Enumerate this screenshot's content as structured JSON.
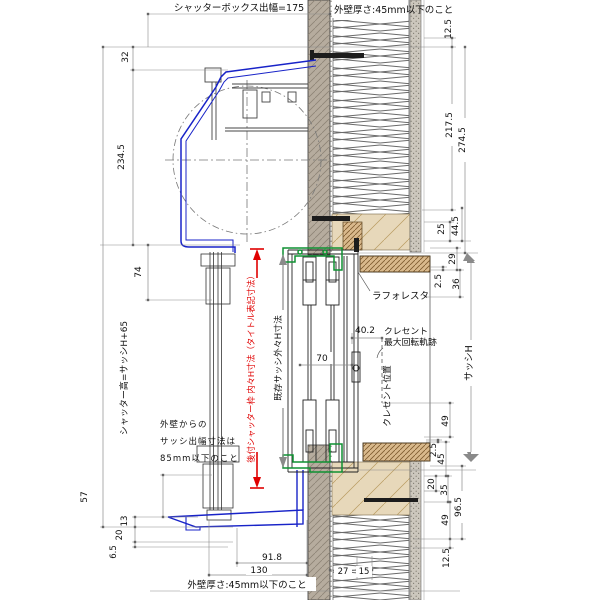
{
  "notes": {
    "shutter_box_depth": "シャッターボックス出幅=175",
    "wall_thickness_top": "外壁厚さ:45mm以下のこと",
    "wall_thickness_bottom": "外壁厚さ:45mm以下のこと",
    "offset_note_1": "外壁からの",
    "offset_note_2": "サッシ出幅寸法は",
    "offset_note_3": "85mm以下のこと"
  },
  "labels": {
    "shutter_height": "シャッター高=サッシH+65",
    "retrofit_frame_dim": "後付シャッター枠 内々H寸法（タイトル表記寸法）",
    "existing_sash_dim": "既存サッシ外々H寸法",
    "sash_h": "サッシH",
    "laforesta": "ラフォレスタ",
    "crescent_1": "クレセント",
    "crescent_2": "最大回転軌跡",
    "crescent_position": "クレセント位置"
  },
  "dims": {
    "left": [
      "32",
      "234.5",
      "74",
      "57",
      "13",
      "20",
      "6.5"
    ],
    "right": [
      "12.5",
      "217.5",
      "274.5",
      "25",
      "44.5",
      "29",
      "2.5",
      "36",
      "49",
      "2.5",
      "45",
      "20",
      "35",
      "49",
      "96.5",
      "12.5"
    ],
    "bottom": [
      "91.8",
      "130",
      "27",
      "15"
    ],
    "inner": [
      "70",
      "40.2"
    ]
  },
  "colors": {
    "shutter_frame_blue": "#1823c8",
    "new_frame_green": "#0f9132",
    "highlight_red": "#e00000",
    "wood_hatch": "#d9b98c",
    "wall_clad": "#b6ac9e"
  }
}
